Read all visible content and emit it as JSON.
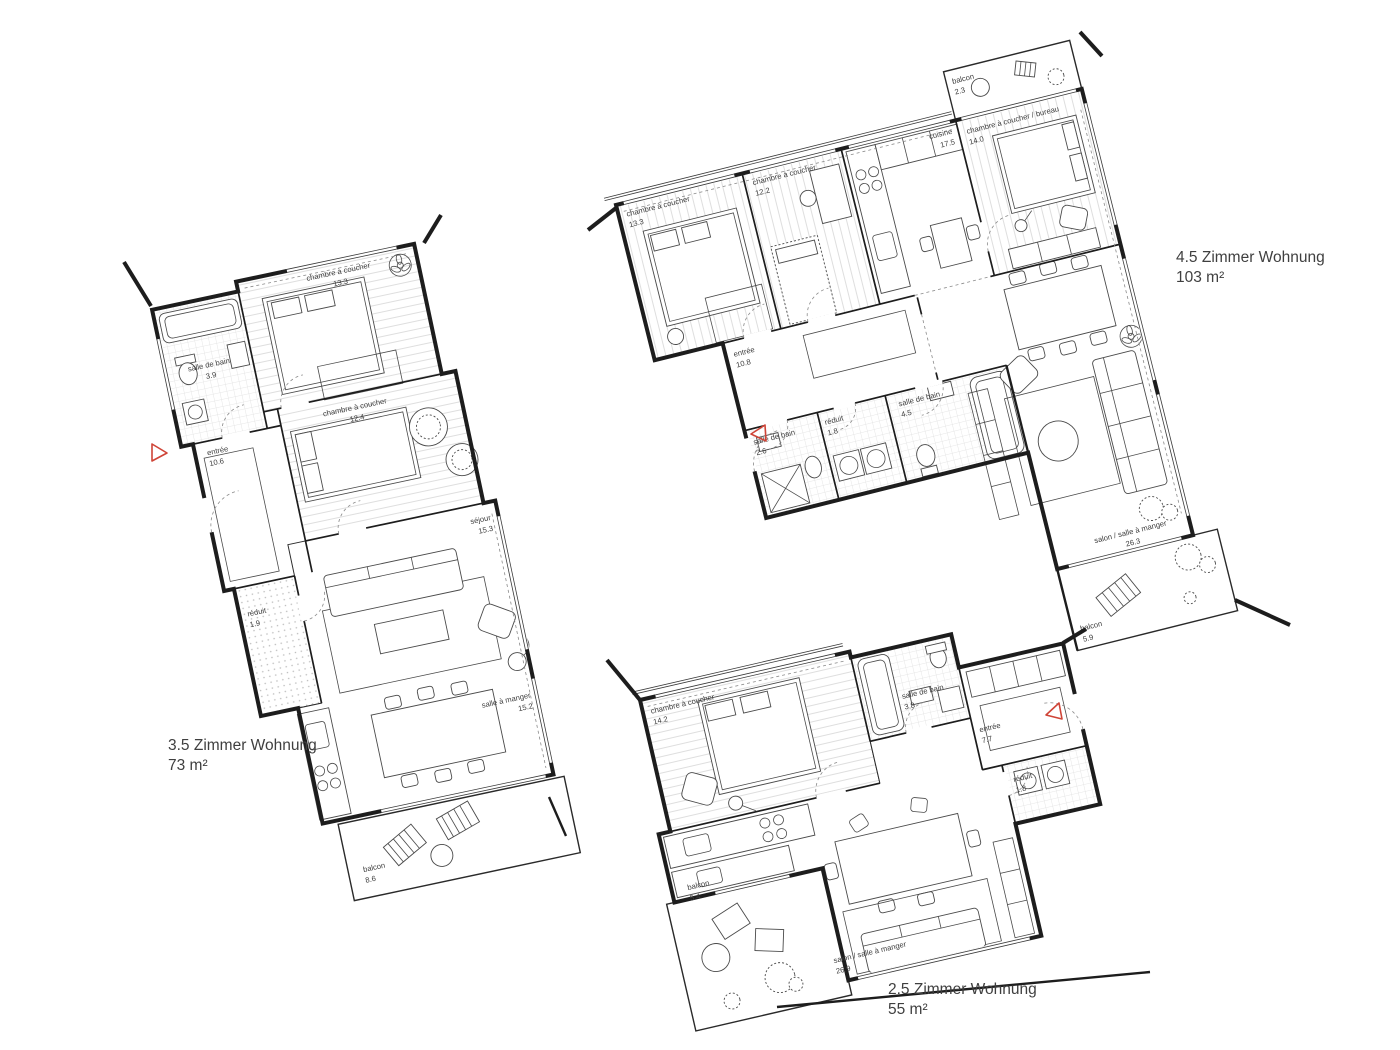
{
  "drawing": {
    "type": "architectural floor plans",
    "colors": {
      "wall": "#1d1d1d",
      "furniture_line": "#4a4a4a",
      "hatch_light": "#dedede",
      "entry_marker_red": "#cf4437",
      "text": "#3e3e3e",
      "background": "#ffffff"
    }
  },
  "apartments": [
    {
      "title": "3.5 Zimmer Wohnung",
      "area": "73 m²",
      "rooms": [
        {
          "name": "salle de bain",
          "area": "3.9"
        },
        {
          "name": "chambre à coucher",
          "area": "13.3"
        },
        {
          "name": "entrée",
          "area": "10.6"
        },
        {
          "name": "chambre à coucher",
          "area": "12.4"
        },
        {
          "name": "séjour",
          "area": "15.3"
        },
        {
          "name": "réduit",
          "area": "1.9"
        },
        {
          "name": "salle à manger",
          "area": "15.2"
        },
        {
          "name": "balcon",
          "area": "8.6"
        }
      ]
    },
    {
      "title": "4.5 Zimmer Wohnung",
      "area": "103 m²",
      "rooms": [
        {
          "name": "chambre à coucher",
          "area": "13.3"
        },
        {
          "name": "chambre à coucher",
          "area": "12.2"
        },
        {
          "name": "cuisine",
          "area": "17.5"
        },
        {
          "name": "chambre à coucher / bureau",
          "area": "14.0"
        },
        {
          "name": "balcon",
          "area": "2.3"
        },
        {
          "name": "entrée",
          "area": "10.8"
        },
        {
          "name": "salle de bain",
          "area": "2.6"
        },
        {
          "name": "réduit",
          "area": "1.8"
        },
        {
          "name": "salle de bain",
          "area": "4.5"
        },
        {
          "name": "salon / salle à manger",
          "area": "26.3"
        },
        {
          "name": "balcon",
          "area": "5.9"
        }
      ]
    },
    {
      "title": "2.5 Zimmer Wohnung",
      "area": "55 m²",
      "rooms": [
        {
          "name": "chambre à coucher",
          "area": "14.2"
        },
        {
          "name": "salle de bain",
          "area": "3.8"
        },
        {
          "name": "entrée",
          "area": "7.7"
        },
        {
          "name": "réduit",
          "area": "1.8"
        },
        {
          "name": "salon / salle à manger",
          "area": "26.9"
        },
        {
          "name": "balcon",
          "area": "5.4"
        }
      ]
    }
  ]
}
